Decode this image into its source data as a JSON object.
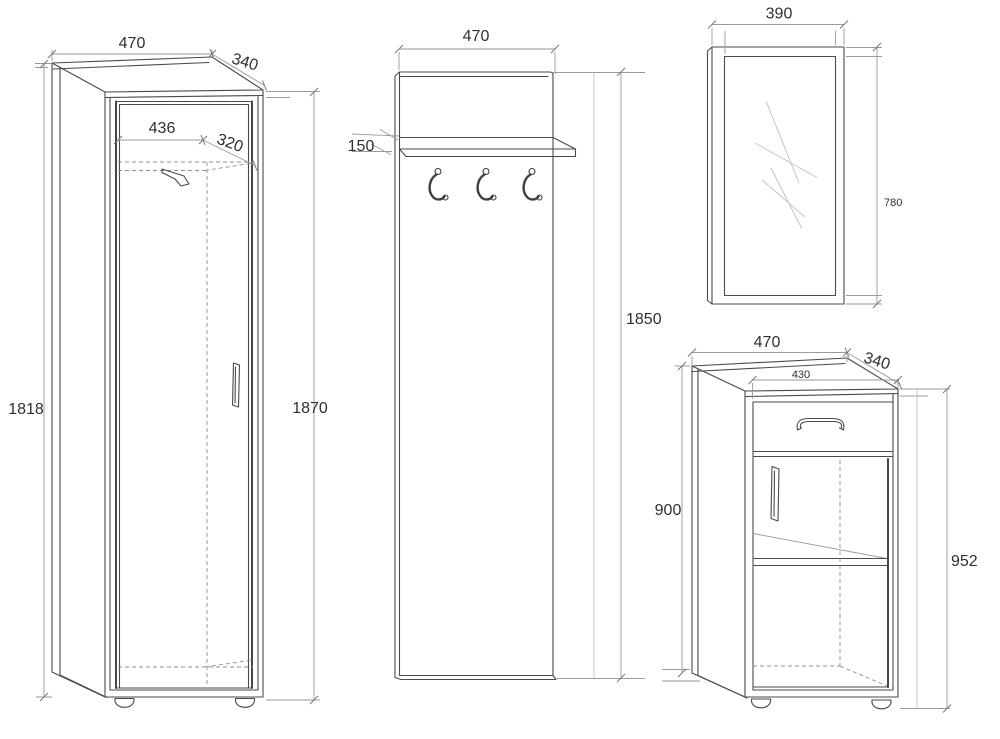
{
  "colors": {
    "background": "#ffffff",
    "edge_line": "#4a4a4a",
    "dimension_line": "#9a9a9a",
    "text": "#2f2f2f"
  },
  "wardrobe": {
    "width": "470",
    "depth": "340",
    "inner_width": "436",
    "inner_depth": "320",
    "height_left": "1818",
    "height_right": "1870"
  },
  "coat_panel": {
    "width": "470",
    "shelf_depth": "150",
    "height": "1850"
  },
  "mirror": {
    "width": "390",
    "height": "780"
  },
  "cabinet": {
    "width": "470",
    "depth": "340",
    "inner_width": "430",
    "height_left": "900",
    "height_right": "952"
  }
}
